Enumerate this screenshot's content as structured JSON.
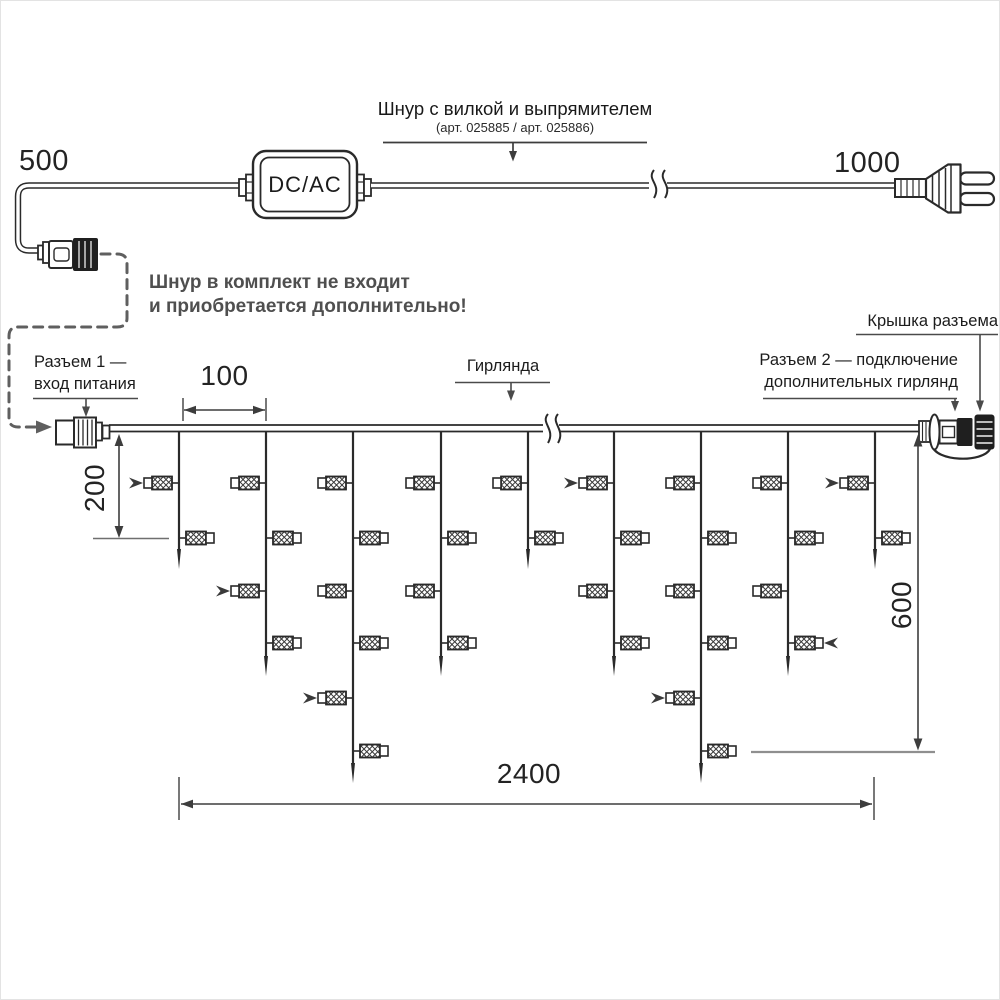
{
  "colors": {
    "ink": "#2a2a2a",
    "leader": "#4a4a4a",
    "gray_note": "#4f4f4f",
    "dashed": "#5f5f5f",
    "ref_line": "#8f8f8f"
  },
  "power_cord": {
    "label_line1": "Шнур с вилкой и выпрямителем",
    "label_line2": "(арт. 025885 / арт. 025886)",
    "left_length": "500",
    "right_length": "1000",
    "converter_label": "DC/AC",
    "note_line1": "Шнур в комплект не входит",
    "note_line2": "и приобретается дополнительно!"
  },
  "garland": {
    "connector1_line1": "Разъем 1 —",
    "connector1_line2": "вход питания",
    "garland_label": "Гирлянда",
    "cap_label": "Крышка разъема",
    "connector2_line1": "Разъем 2 — подключение",
    "connector2_line2": "дополнительных гирлянд",
    "dim_drop_spacing": "100",
    "dim_first_drop": "200",
    "dim_height": "600",
    "dim_length": "2400"
  },
  "diagram": {
    "wire_y": 427,
    "drops": [
      {
        "x": 178,
        "tip": 568,
        "lamps": [
          {
            "side": "L",
            "y": 482,
            "arrow": "R"
          },
          {
            "side": "R",
            "y": 537
          }
        ]
      },
      {
        "x": 265,
        "tip": 675,
        "lamps": [
          {
            "side": "L",
            "y": 482
          },
          {
            "side": "R",
            "y": 537
          },
          {
            "side": "L",
            "y": 590,
            "arrow": "R"
          },
          {
            "side": "R",
            "y": 642
          }
        ]
      },
      {
        "x": 352,
        "tip": 782,
        "lamps": [
          {
            "side": "L",
            "y": 482
          },
          {
            "side": "R",
            "y": 537
          },
          {
            "side": "L",
            "y": 590
          },
          {
            "side": "R",
            "y": 642
          },
          {
            "side": "L",
            "y": 697,
            "arrow": "R"
          },
          {
            "side": "R",
            "y": 750
          }
        ]
      },
      {
        "x": 440,
        "tip": 675,
        "lamps": [
          {
            "side": "L",
            "y": 482
          },
          {
            "side": "R",
            "y": 537
          },
          {
            "side": "L",
            "y": 590
          },
          {
            "side": "R",
            "y": 642
          }
        ]
      },
      {
        "x": 527,
        "tip": 568,
        "lamps": [
          {
            "side": "L",
            "y": 482
          },
          {
            "side": "R",
            "y": 537
          }
        ]
      },
      {
        "x": 613,
        "tip": 675,
        "lamps": [
          {
            "side": "L",
            "y": 482,
            "arrow": "R"
          },
          {
            "side": "R",
            "y": 537
          },
          {
            "side": "L",
            "y": 590
          },
          {
            "side": "R",
            "y": 642
          }
        ]
      },
      {
        "x": 700,
        "tip": 782,
        "lamps": [
          {
            "side": "L",
            "y": 482
          },
          {
            "side": "R",
            "y": 537
          },
          {
            "side": "L",
            "y": 590
          },
          {
            "side": "R",
            "y": 642
          },
          {
            "side": "L",
            "y": 697,
            "arrow": "R"
          },
          {
            "side": "R",
            "y": 750
          }
        ]
      },
      {
        "x": 787,
        "tip": 675,
        "lamps": [
          {
            "side": "L",
            "y": 482
          },
          {
            "side": "R",
            "y": 537
          },
          {
            "side": "L",
            "y": 590
          },
          {
            "side": "R",
            "y": 642,
            "arrow": "L"
          }
        ]
      },
      {
        "x": 874,
        "tip": 568,
        "lamps": [
          {
            "side": "L",
            "y": 482,
            "arrow": "R"
          },
          {
            "side": "R",
            "y": 537
          }
        ]
      }
    ]
  }
}
